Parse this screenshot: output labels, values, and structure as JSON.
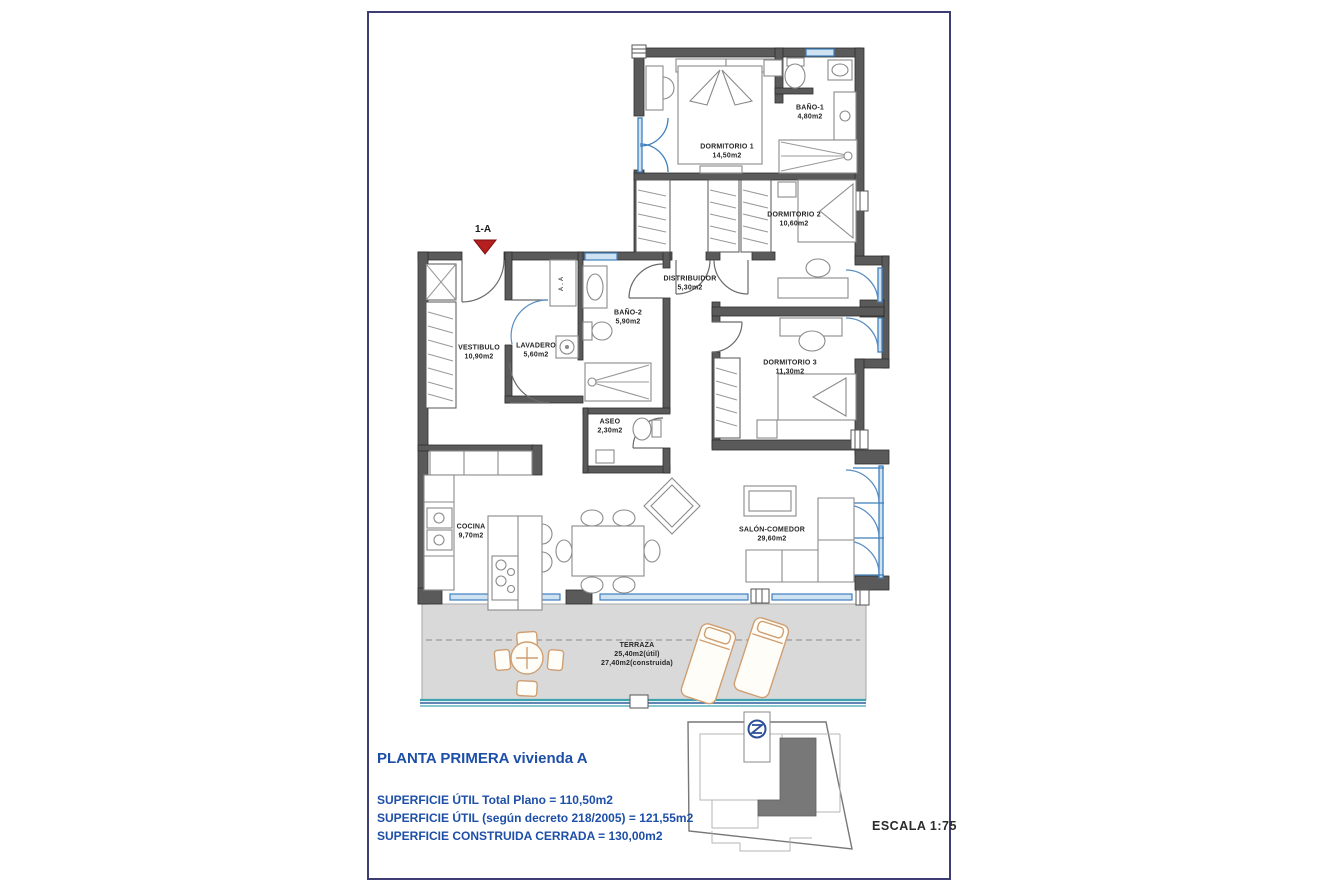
{
  "sheet": {
    "unit_label": "1-A",
    "scale_label": "ESCALA  1:75",
    "ac_label": "A.A",
    "rooms": [
      {
        "name": "DORMITORIO 1",
        "area": "14,50m2"
      },
      {
        "name": "BAÑO-1",
        "area": "4,80m2"
      },
      {
        "name": "DORMITORIO 2",
        "area": "10,60m2"
      },
      {
        "name": "DISTRIBUIDOR",
        "area": "5,30m2"
      },
      {
        "name": "BAÑO-2",
        "area": "5,90m2"
      },
      {
        "name": "VESTIBULO",
        "area": "10,90m2"
      },
      {
        "name": "LAVADERO",
        "area": "5,60m2"
      },
      {
        "name": "DORMITORIO 3",
        "area": "11,30m2"
      },
      {
        "name": "ASEO",
        "area": "2,30m2"
      },
      {
        "name": "COCINA",
        "area": "9,70m2"
      },
      {
        "name": "SALÓN-COMEDOR",
        "area": "29,60m2"
      },
      {
        "name": "TERRAZA",
        "area": "25,40m2(útil)",
        "area2": "27,40m2(construida)"
      }
    ],
    "footer": {
      "title": "PLANTA PRIMERA vivienda A",
      "lines": [
        "SUPERFICIE ÚTIL Total Plano = 110,50m2",
        "SUPERFICIE ÚTIL (según decreto 218/2005) = 121,55m2",
        "SUPERFICIE CONSTRUIDA CERRADA = 130,00m2"
      ]
    },
    "colors": {
      "accent_blue": "#1d4fa8",
      "marker_red": "#b51f1f",
      "wall_gray": "#5a5a5a",
      "window_blue": "#3f7fbe",
      "terrace_teal": "#3fa3b0",
      "terrace_fill": "#d9d9d9"
    }
  }
}
